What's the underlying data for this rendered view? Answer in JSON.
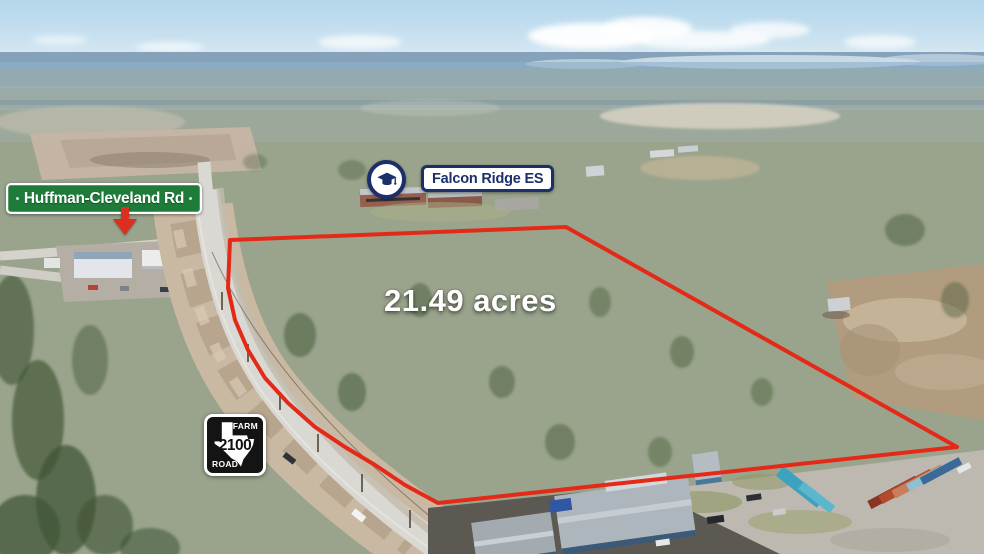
{
  "annotations": {
    "street_sign": {
      "label": "Huffman-Cleveland Rd"
    },
    "school_badge": {
      "label": "Falcon Ridge ES",
      "icon": "graduation-cap-icon"
    },
    "acreage_label": "21.49 acres",
    "highway_sign": {
      "top": "FARM",
      "number": "2100",
      "bottom": "ROAD",
      "icon": "texas-outline-icon"
    }
  },
  "colors": {
    "boundary_red": "#e32a18",
    "street_sign_green": "#1e7b39",
    "school_navy": "#1d2f6b",
    "arrow_red": "#dd2f1f",
    "highway_sign_black": "#141414"
  }
}
